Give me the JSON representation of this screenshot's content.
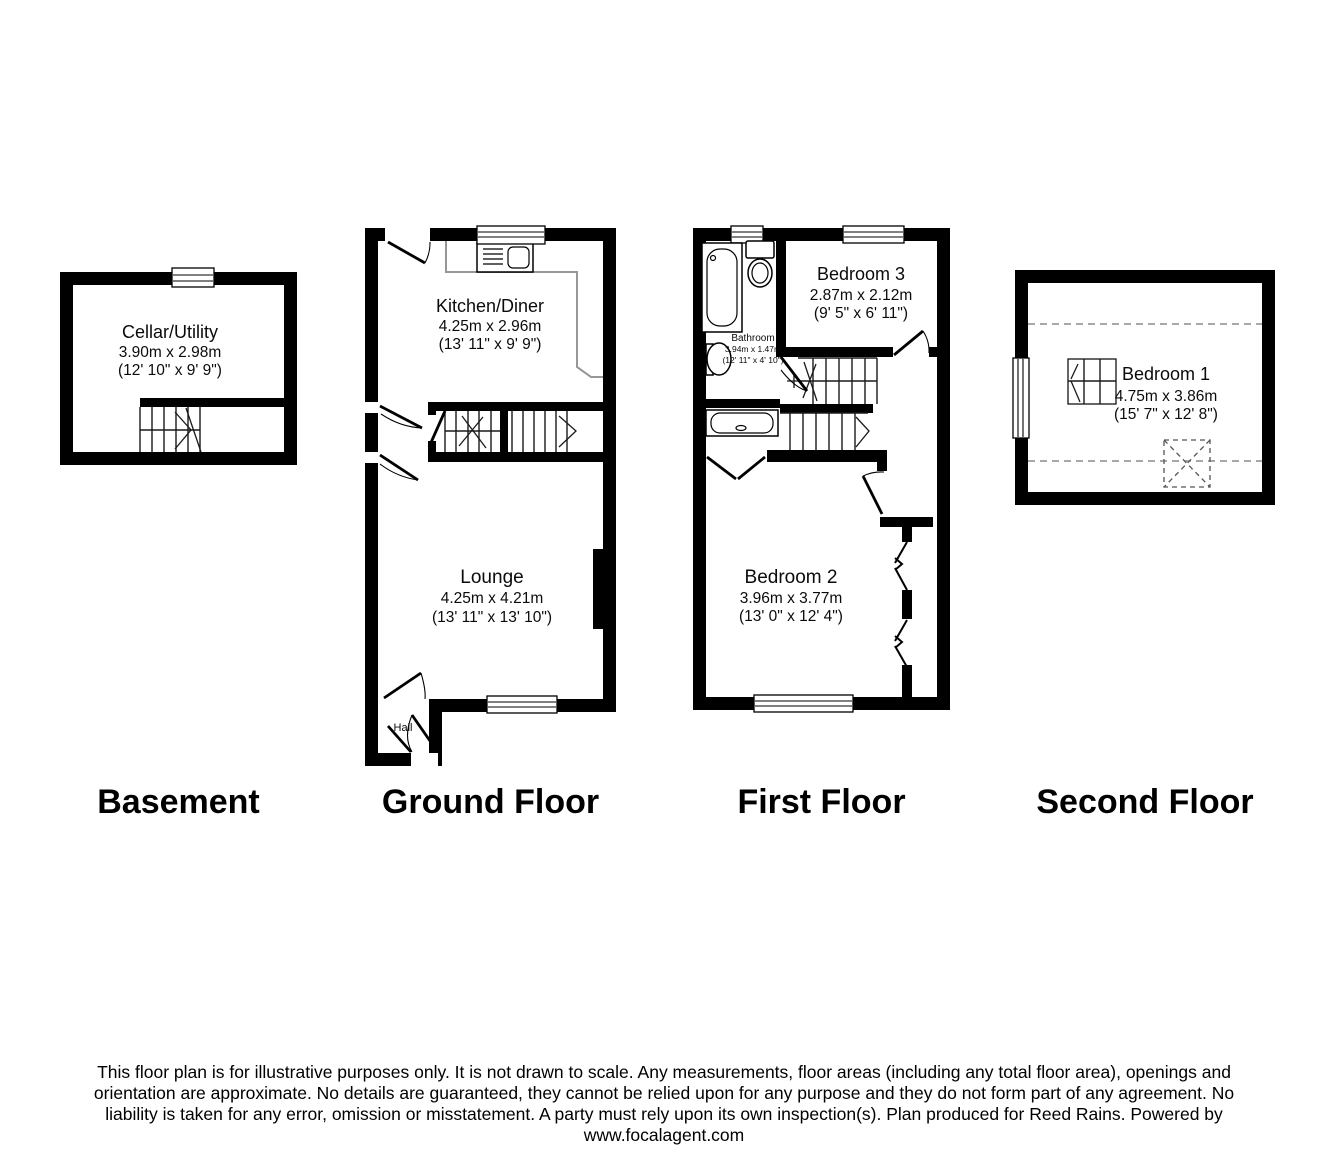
{
  "floors": [
    {
      "title": "Basement",
      "rooms": [
        {
          "name": "Cellar/Utility",
          "metric": "3.90m x 2.98m",
          "imperial": "(12' 10\" x 9' 9\")"
        }
      ]
    },
    {
      "title": "Ground Floor",
      "rooms": [
        {
          "name": "Kitchen/Diner",
          "metric": "4.25m x 2.96m",
          "imperial": "(13' 11\" x 9' 9\")"
        },
        {
          "name": "Lounge",
          "metric": "4.25m x 4.21m",
          "imperial": "(13' 11\" x 13' 10\")"
        },
        {
          "name": "Hall",
          "metric": "",
          "imperial": ""
        }
      ]
    },
    {
      "title": "First Floor",
      "rooms": [
        {
          "name": "Bedroom 3",
          "metric": "2.87m x 2.12m",
          "imperial": "(9' 5\" x 6' 11\")"
        },
        {
          "name": "Bathroom",
          "metric": "3.94m x 1.47m",
          "imperial": "(12' 11\" x 4' 10\")"
        },
        {
          "name": "Bedroom 2",
          "metric": "3.96m x 3.77m",
          "imperial": "(13' 0\" x 12' 4\")"
        }
      ]
    },
    {
      "title": "Second Floor",
      "rooms": [
        {
          "name": "Bedroom 1",
          "metric": "4.75m x 3.86m",
          "imperial": "(15' 7\" x 12' 8\")"
        }
      ]
    }
  ],
  "disclaimer": {
    "lines": [
      "This floor plan is for illustrative purposes only. It is not drawn to scale. Any measurements, floor areas (including any total floor area), openings and",
      "orientation are approximate. No details are guaranteed, they cannot be relied upon for any purpose and they do not form part of any agreement. No",
      "liability is taken for any error, omission or misstatement. A party must rely upon its own inspection(s). Plan produced for Reed Rains. Powered by",
      "www.focalagent.com"
    ]
  },
  "colors": {
    "wall": "#000000",
    "background": "#ffffff",
    "stair_line": "#1a1a1a",
    "counter": "#979797",
    "dashed_eaves": "#8c8c8c"
  }
}
